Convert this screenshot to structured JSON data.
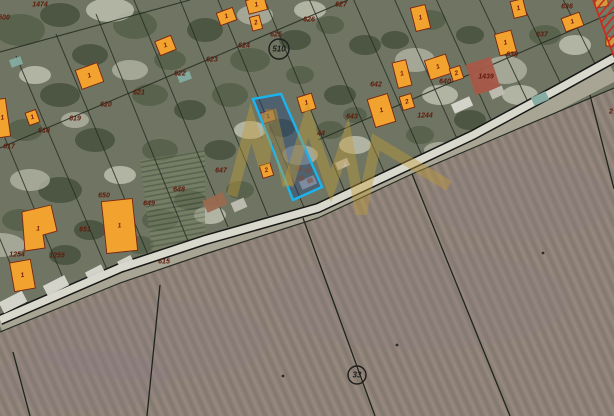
{
  "map": {
    "description": "aerial cadastral map with highlighted parcel",
    "colors": {
      "village_base": "#6f7562",
      "village_dark1": "#414c39",
      "village_dark2": "#515c46",
      "village_light1": "#b2b4a2",
      "village_light2": "#c2c3b4",
      "field_a": "#8e8177",
      "field_b": "#857a70",
      "field_c": "#97897d",
      "field_tint": "#8a7b82",
      "roadside": "#a8a595",
      "road_fill": "#d9d8cd",
      "road_edge": "#171815",
      "parcel_line": "#252b21",
      "building_fill": "#f1a22f",
      "building_stroke": "#7a2410",
      "building_label": "#7a1b0e",
      "roof_red": "#a85948",
      "roof_brown": "#9a6a50",
      "roof_gray": "#c0bdb2",
      "roof_teal": "#84aba1",
      "roof_light": "#d8d8d0",
      "number_color": "#5f1a0c",
      "circle_color": "#1d1d1b",
      "highlight_stroke": "#1ab4ef",
      "highlight_fill": "rgba(28,66,134,0.38)",
      "hatch_red": "#cc2a1e",
      "watermark": "#c19a38",
      "rowcrop_line": "#46543e",
      "rowcrop_bg": "#7b8468"
    },
    "road": {
      "points": "0,320 120,268 205,240 318,208 420,160 473,135 560,88 614,58"
    },
    "field_boundary": {
      "points": "0,332 120,283 205,254 318,218 412,174 508,133 614,88"
    },
    "roadside_band": {
      "points": "0,326 120,276 205,247 318,213 412,168 508,128 614,73"
    },
    "back_lanes": [
      [
        0,
        52,
        190,
        0
      ],
      [
        0,
        148,
        348,
        0
      ],
      [
        318,
        140,
        614,
        12
      ]
    ],
    "parcel_lines": [
      [
        28,
        306,
        -60,
        96
      ],
      [
        68,
        290,
        -20,
        78
      ],
      [
        108,
        272,
        16,
        56
      ],
      [
        148,
        255,
        56,
        34
      ],
      [
        188,
        241,
        96,
        14
      ],
      [
        228,
        227,
        134,
        0
      ],
      [
        268,
        216,
        176,
        -10
      ],
      [
        305,
        210,
        213,
        -12
      ],
      [
        345,
        192,
        253,
        -28
      ],
      [
        385,
        174,
        293,
        -38
      ],
      [
        423,
        158,
        331,
        -52
      ],
      [
        458,
        141,
        366,
        -64
      ],
      [
        493,
        124,
        401,
        -78
      ],
      [
        528,
        102,
        436,
        -92
      ],
      [
        562,
        86,
        470,
        -104
      ],
      [
        597,
        68,
        505,
        -118
      ]
    ],
    "field_lines": [
      [
        590,
        95,
        614,
        189
      ],
      [
        412,
        174,
        510,
        416
      ],
      [
        303,
        218,
        375,
        416
      ],
      [
        160,
        285,
        147,
        416
      ],
      [
        13,
        352,
        30,
        416
      ]
    ],
    "field_specks": [
      [
        283,
        376
      ],
      [
        397,
        345
      ],
      [
        543,
        253
      ]
    ],
    "highlight_parcel": {
      "points": "253,99 281,94 322,187 293,200"
    },
    "buildings": [
      {
        "x": 78,
        "y": 66,
        "w": 23,
        "h": 20,
        "rot": -20,
        "label": "1"
      },
      {
        "x": 27,
        "y": 111,
        "w": 11,
        "h": 13,
        "rot": -20,
        "label": "1"
      },
      {
        "x": -3,
        "y": 99,
        "w": 11,
        "h": 38,
        "rot": -8,
        "label": "1"
      },
      {
        "x": 157,
        "y": 38,
        "w": 17,
        "h": 15,
        "rot": -22,
        "label": "1"
      },
      {
        "x": 218,
        "y": 10,
        "w": 17,
        "h": 13,
        "rot": -20,
        "label": "1"
      },
      {
        "x": 247,
        "y": -2,
        "w": 19,
        "h": 14,
        "rot": -15,
        "label": "1"
      },
      {
        "x": 251,
        "y": 16,
        "w": 10,
        "h": 14,
        "rot": -15,
        "label": "2"
      },
      {
        "x": 261,
        "y": 111,
        "w": 14,
        "h": 11,
        "rot": -17,
        "label": "1"
      },
      {
        "x": 261,
        "y": 164,
        "w": 11,
        "h": 13,
        "rot": -17,
        "label": "2"
      },
      {
        "x": 299,
        "y": 95,
        "w": 15,
        "h": 16,
        "rot": -17,
        "label": "1"
      },
      {
        "x": 371,
        "y": 96,
        "w": 21,
        "h": 29,
        "rot": -17,
        "label": "1"
      },
      {
        "x": 401,
        "y": 95,
        "w": 12,
        "h": 14,
        "rot": -17,
        "label": "2"
      },
      {
        "x": 413,
        "y": 6,
        "w": 15,
        "h": 24,
        "rot": -14,
        "label": "1"
      },
      {
        "x": 395,
        "y": 61,
        "w": 14,
        "h": 26,
        "rot": -14,
        "label": "1"
      },
      {
        "x": 427,
        "y": 57,
        "w": 22,
        "h": 20,
        "rot": -18,
        "label": "1"
      },
      {
        "x": 451,
        "y": 67,
        "w": 11,
        "h": 13,
        "rot": -18,
        "label": "2"
      },
      {
        "x": 512,
        "y": 0,
        "w": 13,
        "h": 17,
        "rot": -14,
        "label": "1"
      },
      {
        "x": 563,
        "y": 15,
        "w": 19,
        "h": 14,
        "rot": -20,
        "label": "1"
      },
      {
        "x": 595,
        "y": -2,
        "w": 13,
        "h": 9,
        "rot": -10,
        "label": ""
      },
      {
        "x": 606,
        "y": 37,
        "w": 9,
        "h": 9,
        "rot": 0,
        "label": ""
      },
      {
        "x": 104,
        "y": 200,
        "w": 31,
        "h": 52,
        "rot": -6,
        "label": "1"
      },
      {
        "x": 12,
        "y": 261,
        "w": 21,
        "h": 29,
        "rot": -10,
        "label": "1"
      },
      {
        "x": 497,
        "y": 32,
        "w": 17,
        "h": 22,
        "rot": -15,
        "label": "1"
      }
    ],
    "l_building": {
      "points": "22,212 51,205 57,231 43,235 45,248 25,251",
      "label": "1",
      "lx": 38,
      "ly": 229
    },
    "muted_buildings": [
      {
        "x": 470,
        "y": 60,
        "w": 26,
        "h": 32,
        "rot": -18,
        "roof": "roof_red"
      },
      {
        "x": 204,
        "y": 196,
        "w": 22,
        "h": 13,
        "rot": -24,
        "roof": "roof_brown"
      },
      {
        "x": 232,
        "y": 200,
        "w": 14,
        "h": 10,
        "rot": -24,
        "roof": "roof_gray"
      },
      {
        "x": 300,
        "y": 178,
        "w": 16,
        "h": 9,
        "rot": -24,
        "roof": "roof_gray"
      },
      {
        "x": 336,
        "y": 160,
        "w": 13,
        "h": 8,
        "rot": -24,
        "roof": "roof_gray"
      },
      {
        "x": 532,
        "y": 94,
        "w": 16,
        "h": 9,
        "rot": -24,
        "roof": "roof_teal"
      },
      {
        "x": 10,
        "y": 58,
        "w": 12,
        "h": 8,
        "rot": -20,
        "roof": "roof_teal"
      },
      {
        "x": 178,
        "y": 73,
        "w": 13,
        "h": 8,
        "rot": -20,
        "roof": "roof_teal"
      },
      {
        "x": 44,
        "y": 280,
        "w": 24,
        "h": 11,
        "rot": -27,
        "roof": "roof_light"
      },
      {
        "x": 86,
        "y": 268,
        "w": 18,
        "h": 9,
        "rot": -27,
        "roof": "roof_light"
      },
      {
        "x": 118,
        "y": 258,
        "w": 15,
        "h": 8,
        "rot": -27,
        "roof": "roof_light"
      },
      {
        "x": 0,
        "y": 296,
        "w": 26,
        "h": 12,
        "rot": -27,
        "roof": "roof_light"
      },
      {
        "x": 452,
        "y": 100,
        "w": 20,
        "h": 10,
        "rot": -24,
        "roof": "roof_light"
      },
      {
        "x": 490,
        "y": 88,
        "w": 14,
        "h": 9,
        "rot": -24,
        "roof": "roof_gray"
      }
    ],
    "parcel_numbers": [
      {
        "text": "1474",
        "x": 40,
        "y": 5
      },
      {
        "text": "500",
        "x": 4,
        "y": 18
      },
      {
        "text": "617",
        "x": 9,
        "y": 147
      },
      {
        "text": "618",
        "x": 44,
        "y": 131
      },
      {
        "text": "619",
        "x": 75,
        "y": 119
      },
      {
        "text": "620",
        "x": 106,
        "y": 105
      },
      {
        "text": "621",
        "x": 139,
        "y": 93
      },
      {
        "text": "622",
        "x": 180,
        "y": 74
      },
      {
        "text": "623",
        "x": 212,
        "y": 60
      },
      {
        "text": "624",
        "x": 244,
        "y": 46
      },
      {
        "text": "625",
        "x": 276,
        "y": 35
      },
      {
        "text": "626",
        "x": 309,
        "y": 20
      },
      {
        "text": "627",
        "x": 341,
        "y": 5
      },
      {
        "text": "636",
        "x": 567,
        "y": 7
      },
      {
        "text": "637",
        "x": 542,
        "y": 35
      },
      {
        "text": "638",
        "x": 512,
        "y": 55
      },
      {
        "text": "1439",
        "x": 486,
        "y": 77
      },
      {
        "text": "640",
        "x": 445,
        "y": 82
      },
      {
        "text": "642",
        "x": 376,
        "y": 85
      },
      {
        "text": "643",
        "x": 352,
        "y": 117
      },
      {
        "text": "44",
        "x": 321,
        "y": 134
      },
      {
        "text": "1244",
        "x": 425,
        "y": 116
      },
      {
        "text": "647",
        "x": 221,
        "y": 171
      },
      {
        "text": "648",
        "x": 179,
        "y": 190
      },
      {
        "text": "649",
        "x": 149,
        "y": 204
      },
      {
        "text": "650",
        "x": 104,
        "y": 196
      },
      {
        "text": "651",
        "x": 85,
        "y": 230
      },
      {
        "text": "1254",
        "x": 17,
        "y": 255
      },
      {
        "text": "1255",
        "x": 57,
        "y": 256
      },
      {
        "text": "615",
        "x": 164,
        "y": 262
      },
      {
        "text": "2",
        "x": 611,
        "y": 112
      }
    ],
    "circled": [
      {
        "text": "510",
        "x": 279,
        "y": 49,
        "r": 10
      },
      {
        "text": "33",
        "x": 357,
        "y": 375,
        "r": 9
      }
    ],
    "hatch_zone": {
      "points": "593,0 614,0 614,57"
    },
    "watermark_paths": [
      "M232,196 L251,123 L264,166 L271,110 L288,186",
      "M288,186 L308,120 L331,186 L347,139 L361,214 L376,142 L449,186"
    ],
    "garden_squares": [
      [
        296,
        166
      ],
      [
        305,
        168
      ],
      [
        298,
        176
      ],
      [
        307,
        178
      ]
    ]
  }
}
